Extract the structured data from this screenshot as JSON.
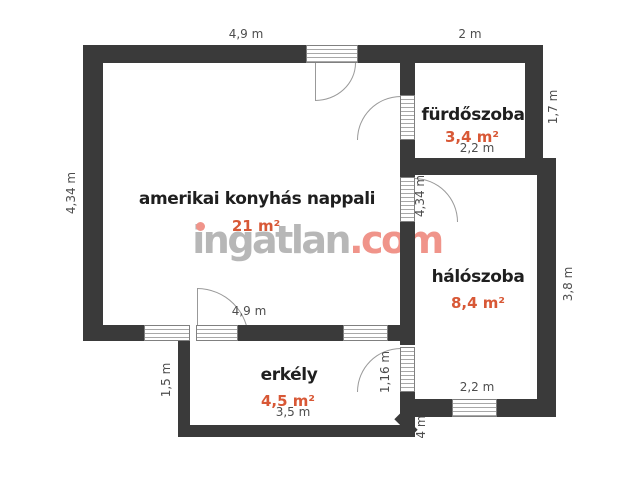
{
  "watermark": {
    "prefix": "ingatlan",
    "suffix": ".com"
  },
  "rooms": {
    "living": {
      "name": "amerikai konyhás nappali",
      "area": "21 m²"
    },
    "bathroom": {
      "name": "fürdőszoba",
      "area": "3,4 m²",
      "inner_width": "2,2 m"
    },
    "bedroom": {
      "name": "hálószoba",
      "area": "8,4 m²",
      "inner_width": "2,2 m"
    },
    "balcony": {
      "name": "erkély",
      "area": "4,5 m²",
      "inner_width": "3,5 m"
    }
  },
  "dimensions": {
    "living_top": "4,9 m",
    "bathroom_top": "2 m",
    "living_left": "4,34 m",
    "bathroom_right": "1,7 m",
    "bedroom_door": "4,34 m",
    "bedroom_right": "3,8 m",
    "living_bottom": "4,9 m",
    "balcony_left": "1,5 m",
    "balcony_door": "1,16 m",
    "corner_partial": "4 m"
  },
  "colors": {
    "wall": "#3a3a3a",
    "room_text": "#1f1f1f",
    "area_text": "#d85836",
    "dimension_text": "#4d4d4d",
    "watermark_gray": "#b7b7b7",
    "watermark_accent": "#f0948a"
  }
}
